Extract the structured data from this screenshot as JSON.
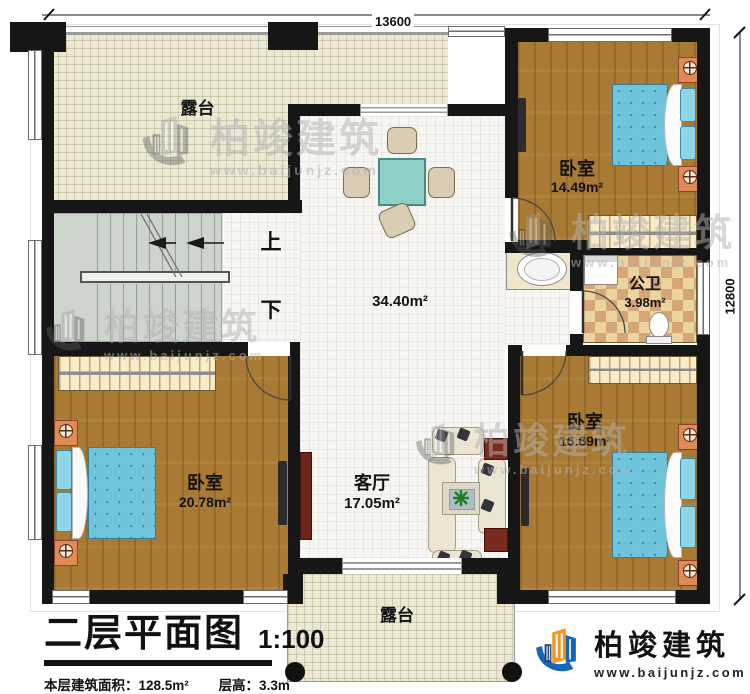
{
  "dimensions": {
    "width": "13600",
    "height": "12800"
  },
  "rooms": {
    "terrace_top": {
      "label": "露台"
    },
    "terrace_bottom": {
      "label": "露台"
    },
    "hall": {
      "area": "34.40m²"
    },
    "bedroom_top_right": {
      "label": "卧室",
      "area": "14.49m²"
    },
    "bathroom": {
      "label": "公卫",
      "area": "3.98m²"
    },
    "bedroom_bottom_right": {
      "label": "卧室",
      "area": "16.69m²"
    },
    "bedroom_bottom_left": {
      "label": "卧室",
      "area": "20.78m²"
    },
    "living_room": {
      "label": "客厅",
      "area": "17.05m²"
    }
  },
  "stairs": {
    "up_label": "上",
    "down_label": "下"
  },
  "title_block": {
    "title": "二层平面图",
    "scale": "1:100",
    "floor_area": "本层建筑面积：128.5m²",
    "floor_height": "层高：3.3m"
  },
  "brand": {
    "name": "柏竣建筑",
    "website": "www.baijunjz.com"
  },
  "colors": {
    "wall": "#161616",
    "wood_floor": "#a97a33",
    "terrace_floor": "#ece8d3",
    "tile_floor": "#f7f6f2",
    "stairs_floor": "#ccd4cb",
    "bed": "#6fc3da",
    "checker_light": "#ead59e",
    "checker_dark": "#d6a678",
    "logo_blue": "#1565b8",
    "logo_orange": "#f7941d"
  }
}
